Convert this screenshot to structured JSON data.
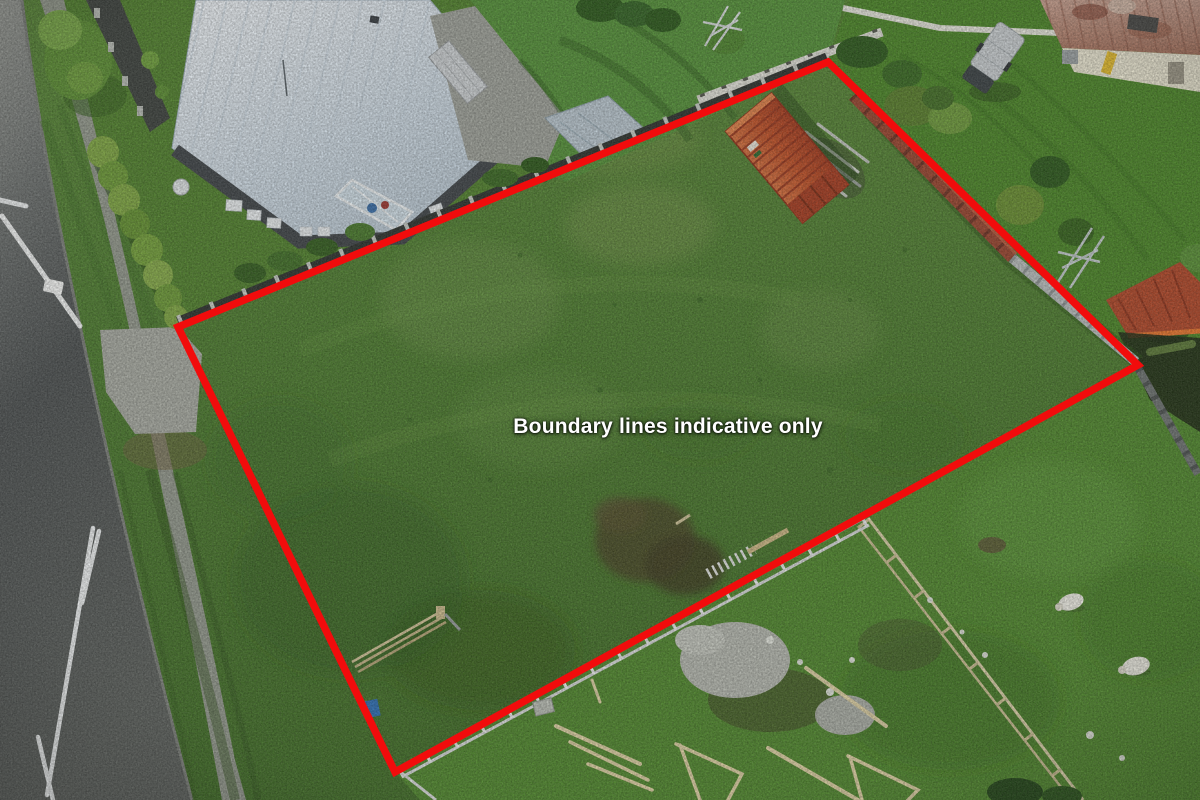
{
  "overlay": {
    "text": "Boundary lines indicative only",
    "text_color": "#ffffff"
  },
  "boundary": {
    "color": "#f10c0c",
    "stroke_width": 7.5,
    "points": "178,327 828,62 1138,365 395,772"
  },
  "scene": {
    "type": "aerial-drone-photo",
    "sheep_count": 2,
    "objects": [
      "road",
      "road-edge-line",
      "sign-pole",
      "footpath",
      "grass-verge",
      "driveway",
      "hedge",
      "house-roof",
      "satellite-dish",
      "conservatory",
      "patio",
      "shed-roof",
      "clothesline",
      "boundary-fence",
      "shipping-container",
      "lumber-pile",
      "block-wall",
      "white-fence",
      "vehicle",
      "barn",
      "trees",
      "metal-frame",
      "second-container",
      "rusty-fence",
      "rail-fence",
      "sheep",
      "gravel-patch",
      "soil-patch",
      "timber-framing",
      "construction-fence",
      "timber-rail-fence"
    ]
  },
  "palette": {
    "parcel_grass": "#4d7c30",
    "bright_lawn": "#55913a",
    "road": "#54585a",
    "house_roof": "#d9e2ea",
    "container_orange": "#c4532e",
    "rusty_fence": "#9a4631",
    "barn_roof": "#b07c68",
    "timber": "#d9cfa8",
    "gravel": "#b5b8b0"
  }
}
